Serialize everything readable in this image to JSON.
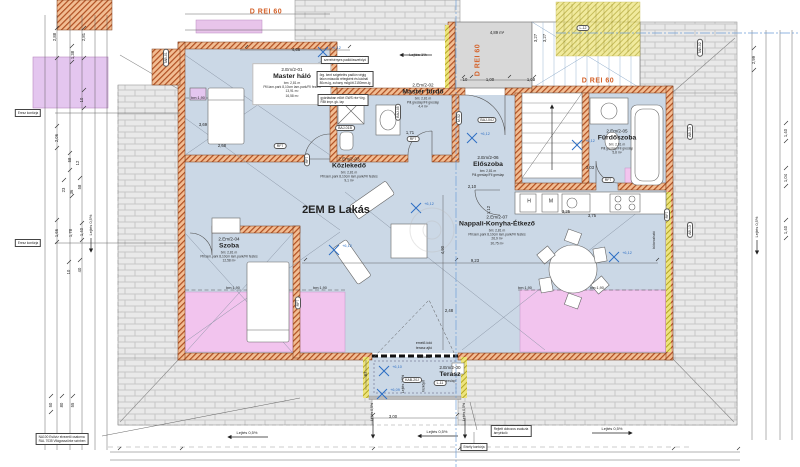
{
  "drawing": {
    "apartment_label": "2EM B Lakás",
    "fire_rating": "D REI 60",
    "colors": {
      "floor": "#cbd8e6",
      "pink": "#f2c4ee",
      "purple": "#e4c6ef",
      "wall_hatch": "#b04f22",
      "brick": "#e9e9e9",
      "yellow": "#ede47d",
      "orange_text": "#d4622a",
      "level_blue": "#2e6fc4",
      "dim_text": "#222222"
    }
  },
  "rooms": [
    {
      "id": "2.Em/2-01",
      "name": "Master háló",
      "lines": [
        "bm: 2,81 m",
        "Pill.lam.park 8,10cm lam.park/Fil festés",
        "13,91 m²",
        "16,58 m²"
      ],
      "x": 292,
      "y": 84,
      "card": true
    },
    {
      "id": "2.Em/2-02",
      "name": "Master fürdő",
      "lines": [
        "bm: 2,81 m",
        "Pill.greslap/Fil greslap",
        "4,4 m²"
      ],
      "x": 423,
      "y": 96
    },
    {
      "id": "2.Em/2-03",
      "name": "Közlekedő",
      "lines": [
        "bm: 2,81 m",
        "Pill.lam.park 8,10cm lam.park/Fil festés",
        "9,1 m²"
      ],
      "x": 349,
      "y": 170
    },
    {
      "id": "2.Em/2-04",
      "name": "Szoba",
      "lines": [
        "bm: 2,81 m",
        "Pill.lam.park 8,10cm lam.park/Fil festés",
        "12,58 m²"
      ],
      "x": 229,
      "y": 250
    },
    {
      "id": "2.Em/2-05",
      "name": "Fürdőszoba",
      "lines": [
        "bm: 2,81 m",
        "Pill.greslap/Fil greslap",
        "5,8 m²"
      ],
      "x": 617,
      "y": 142
    },
    {
      "id": "2.Em/2-06",
      "name": "Előszoba",
      "lines": [
        "bm: 2,81 m",
        "Pill.greslap/Fil greslap"
      ],
      "x": 488,
      "y": 166
    },
    {
      "id": "2.Em/2-07",
      "name": "Nappali-Konyha-Étkező",
      "lines": [
        "bm: 2,81 m",
        "Pill.lam.park 8,10cm lam.park/Fil festés",
        "26,9 m²",
        "30,75 m²"
      ],
      "x": 497,
      "y": 230
    },
    {
      "id": "2.Em/2-00",
      "name": "Terasz",
      "lines": [
        "greslap"
      ],
      "x": 450,
      "y": 374
    }
  ],
  "labels": [
    {
      "t": "2EM B Lakás",
      "x": 336,
      "y": 211,
      "s": 11,
      "b": 1
    },
    {
      "t": "D REI 60",
      "x": 266,
      "y": 12,
      "s": 7,
      "b": 1,
      "c": "orange"
    },
    {
      "t": "D REI 60",
      "x": 478,
      "y": 60,
      "s": 7,
      "b": 1,
      "c": "orange",
      "r": 1
    },
    {
      "t": "D REI 60",
      "x": 598,
      "y": 81,
      "s": 7,
      "b": 1,
      "c": "orange"
    },
    {
      "t": "2,88",
      "x": 55,
      "y": 37,
      "s": 4.2,
      "r": 1
    },
    {
      "t": "2,81",
      "x": 84,
      "y": 37,
      "s": 4.2,
      "r": 1
    },
    {
      "t": "1,38",
      "x": 73,
      "y": 55,
      "s": 4.2,
      "r": 1
    },
    {
      "t": "10",
      "x": 82,
      "y": 100,
      "s": 4.2,
      "r": 1
    },
    {
      "t": "2,06",
      "x": 57,
      "y": 138,
      "s": 4.2,
      "r": 1
    },
    {
      "t": "58",
      "x": 70,
      "y": 160,
      "s": 4.2,
      "r": 1
    },
    {
      "t": "12",
      "x": 78,
      "y": 163,
      "s": 4.2,
      "r": 1
    },
    {
      "t": "23",
      "x": 64,
      "y": 190,
      "s": 4.2,
      "r": 1
    },
    {
      "t": "36",
      "x": 72,
      "y": 192,
      "s": 4.2,
      "r": 1
    },
    {
      "t": "58",
      "x": 80,
      "y": 187,
      "s": 4.2,
      "r": 1
    },
    {
      "t": "1,66",
      "x": 57,
      "y": 233,
      "s": 4.2,
      "r": 1
    },
    {
      "t": "1,78",
      "x": 71,
      "y": 233,
      "s": 4.2,
      "r": 1
    },
    {
      "t": "1,40",
      "x": 82,
      "y": 232,
      "s": 4.2,
      "r": 1
    },
    {
      "t": "10",
      "x": 69,
      "y": 272,
      "s": 4.2,
      "r": 1
    },
    {
      "t": "40",
      "x": 80,
      "y": 270,
      "s": 4.2,
      "r": 1
    },
    {
      "t": "50",
      "x": 51,
      "y": 405,
      "s": 4.2,
      "r": 1
    },
    {
      "t": "80",
      "x": 62,
      "y": 405,
      "s": 4.2,
      "r": 1
    },
    {
      "t": "55",
      "x": 73,
      "y": 405,
      "s": 4.2,
      "r": 1
    },
    {
      "t": "2,99",
      "x": 754,
      "y": 60,
      "s": 4.2,
      "r": 1
    },
    {
      "t": "1,40",
      "x": 786,
      "y": 133,
      "s": 4.2,
      "r": 1
    },
    {
      "t": "1,04",
      "x": 786,
      "y": 178,
      "s": 4.2,
      "r": 1
    },
    {
      "t": "1,40",
      "x": 786,
      "y": 230,
      "s": 4.2,
      "r": 1
    },
    {
      "t": "4,66",
      "x": 296,
      "y": 50,
      "s": 4.2
    },
    {
      "t": "10",
      "x": 465,
      "y": 80,
      "s": 4.2
    },
    {
      "t": "1,00",
      "x": 490,
      "y": 80,
      "s": 4.2
    },
    {
      "t": "1,00",
      "x": 531,
      "y": 80,
      "s": 4.2
    },
    {
      "t": "3,27",
      "x": 536,
      "y": 38,
      "s": 4.2,
      "r": 1
    },
    {
      "t": "3,27",
      "x": 545,
      "y": 38,
      "s": 4.2,
      "r": 1
    },
    {
      "t": "4,89 m²",
      "x": 497,
      "y": 33,
      "s": 4.2
    },
    {
      "t": "2,10",
      "x": 472,
      "y": 187,
      "s": 4.2
    },
    {
      "t": "1,12",
      "x": 489,
      "y": 210,
      "s": 4.2,
      "r": 1
    },
    {
      "t": "1,71",
      "x": 410,
      "y": 133,
      "s": 4.2
    },
    {
      "t": "3,69",
      "x": 203,
      "y": 125,
      "s": 4.2
    },
    {
      "t": "2,68",
      "x": 222,
      "y": 146,
      "s": 4.2
    },
    {
      "t": "3,03",
      "x": 590,
      "y": 168,
      "s": 4.2
    },
    {
      "t": "3,25",
      "x": 566,
      "y": 212,
      "s": 4.2
    },
    {
      "t": "3,75",
      "x": 592,
      "y": 216,
      "s": 4.2
    },
    {
      "t": "9,23",
      "x": 475,
      "y": 261,
      "s": 4.2
    },
    {
      "t": "4,90",
      "x": 443,
      "y": 250,
      "s": 4.2,
      "r": 1
    },
    {
      "t": "2,48",
      "x": 449,
      "y": 311,
      "s": 4.2
    },
    {
      "t": "3,00",
      "x": 393,
      "y": 417,
      "s": 4.2
    },
    {
      "t": "87",
      "x": 366,
      "y": 374,
      "s": 4.2,
      "r": 1
    },
    {
      "t": "bm:1,90",
      "x": 198,
      "y": 98,
      "s": 3.8
    },
    {
      "t": "bm:1,90",
      "x": 233,
      "y": 288,
      "s": 3.8
    },
    {
      "t": "bm:1,90",
      "x": 320,
      "y": 288,
      "s": 3.8
    },
    {
      "t": "bm:1,90",
      "x": 525,
      "y": 288,
      "s": 3.8
    },
    {
      "t": "bm:1,90",
      "x": 597,
      "y": 288,
      "s": 3.8
    },
    {
      "t": "Lejtés 1%",
      "x": 418,
      "y": 55,
      "s": 4
    },
    {
      "t": "Lejtés 0,5%",
      "x": 247,
      "y": 433,
      "s": 4
    },
    {
      "t": "Lejtés 0,5%",
      "x": 437,
      "y": 432,
      "s": 4
    },
    {
      "t": "Lejtés 0,5%",
      "x": 612,
      "y": 429,
      "s": 4
    },
    {
      "t": "Lejtés 0,5%",
      "x": 91,
      "y": 225,
      "s": 4,
      "r": 1
    },
    {
      "t": "Lejtés 0,5%",
      "x": 757,
      "y": 227,
      "s": 4,
      "r": 1
    },
    {
      "t": "Lejtés 0,5%",
      "x": 373,
      "y": 412,
      "s": 3.5,
      "r": 1
    },
    {
      "t": "Lejtés 0,5%",
      "x": 465,
      "y": 412,
      "s": 3.5,
      "r": 1
    },
    {
      "t": "Lejtés 1,5%",
      "x": 404,
      "y": 384,
      "s": 3.5,
      "r": 1
    },
    {
      "t": "Vízköpő",
      "x": 424,
      "y": 386,
      "s": 3.3,
      "r": 1
    },
    {
      "t": "emelő-toló",
      "x": 424,
      "y": 344,
      "s": 3.5
    },
    {
      "t": "terasz ajtó",
      "x": 424,
      "y": 349,
      "s": 3.5
    },
    {
      "t": "zsaluzia",
      "x": 424,
      "y": 358,
      "s": 3.5
    },
    {
      "t": "H",
      "x": 529,
      "y": 202,
      "s": 5
    },
    {
      "t": "M",
      "x": 551,
      "y": 202,
      "s": 5
    },
    {
      "t": "bútorozható",
      "x": 655,
      "y": 240,
      "s": 3.4,
      "r": 1
    }
  ],
  "markers": [
    {
      "t": "BAJ-01B",
      "x": 345,
      "y": 128
    },
    {
      "t": "BAJ-04J",
      "x": 487,
      "y": 120
    },
    {
      "t": "BAJ-05",
      "x": 398,
      "y": 112,
      "r": 1
    },
    {
      "t": "M-52",
      "x": 459,
      "y": 118,
      "r": 1
    },
    {
      "t": "KAB-20J",
      "x": 412,
      "y": 380
    },
    {
      "t": "L-11",
      "x": 440,
      "y": 383
    },
    {
      "t": "L-12",
      "x": 583,
      "y": 28
    },
    {
      "t": "TAB-02",
      "x": 700,
      "y": 48,
      "r": 1
    },
    {
      "t": "TAB-01",
      "x": 166,
      "y": 58,
      "r": 1
    },
    {
      "t": "AB-13",
      "x": 690,
      "y": 132,
      "r": 1
    },
    {
      "t": "AB-13",
      "x": 690,
      "y": 230,
      "r": 1
    },
    {
      "t": "RF7",
      "x": 307,
      "y": 160,
      "r": 1
    },
    {
      "t": "RF7",
      "x": 413,
      "y": 139
    },
    {
      "t": "RF7",
      "x": 608,
      "y": 180
    },
    {
      "t": "RF7",
      "x": 667,
      "y": 215,
      "r": 1
    },
    {
      "t": "RF7",
      "x": 280,
      "y": 146
    },
    {
      "t": "RF7",
      "x": 298,
      "y": 303,
      "r": 1
    }
  ],
  "levels": [
    {
      "t": "+6,12",
      "x": 323,
      "y": 52
    },
    {
      "t": "+6,12",
      "x": 472,
      "y": 138
    },
    {
      "t": "+6,12",
      "x": 577,
      "y": 145
    },
    {
      "t": "+6,12",
      "x": 416,
      "y": 208
    },
    {
      "t": "+6,12",
      "x": 334,
      "y": 250
    },
    {
      "t": "+6,12",
      "x": 614,
      "y": 257
    },
    {
      "t": "+6,10",
      "x": 384,
      "y": 371
    },
    {
      "t": "+6,09",
      "x": 382,
      "y": 394
    }
  ],
  "boxes": [
    {
      "lines": [
        "szerelvényes padlóösszefolyó"
      ],
      "x": 345,
      "y": 60
    },
    {
      "lines": [
        "örg. kent szigetelés padlón végig",
        "falon második rétegként és kádnál",
        "80cm-ig, zuhany mögött 2150mm-ig"
      ],
      "x": 345,
      "y": 79
    },
    {
      "lines": [
        "gyártásban előírt GWS réz+örg.",
        "RBt impr. gk. lap"
      ],
      "x": 343,
      "y": 100
    },
    {
      "lines": [
        "NA100 Esővíz elvezető csatorna",
        "RAL 7035 Világosszürke színben"
      ],
      "x": 62,
      "y": 439
    },
    {
      "lines": [
        "Rejtett dobozos zsaluzia",
        "árnyékoló"
      ],
      "x": 511,
      "y": 431
    },
    {
      "lines": [
        "Erkély kontúrja"
      ],
      "x": 474,
      "y": 447
    },
    {
      "lines": [
        "Eresz kontúrja"
      ],
      "x": 28,
      "y": 113
    },
    {
      "lines": [
        "Eresz kontúrja"
      ],
      "x": 28,
      "y": 243
    }
  ]
}
